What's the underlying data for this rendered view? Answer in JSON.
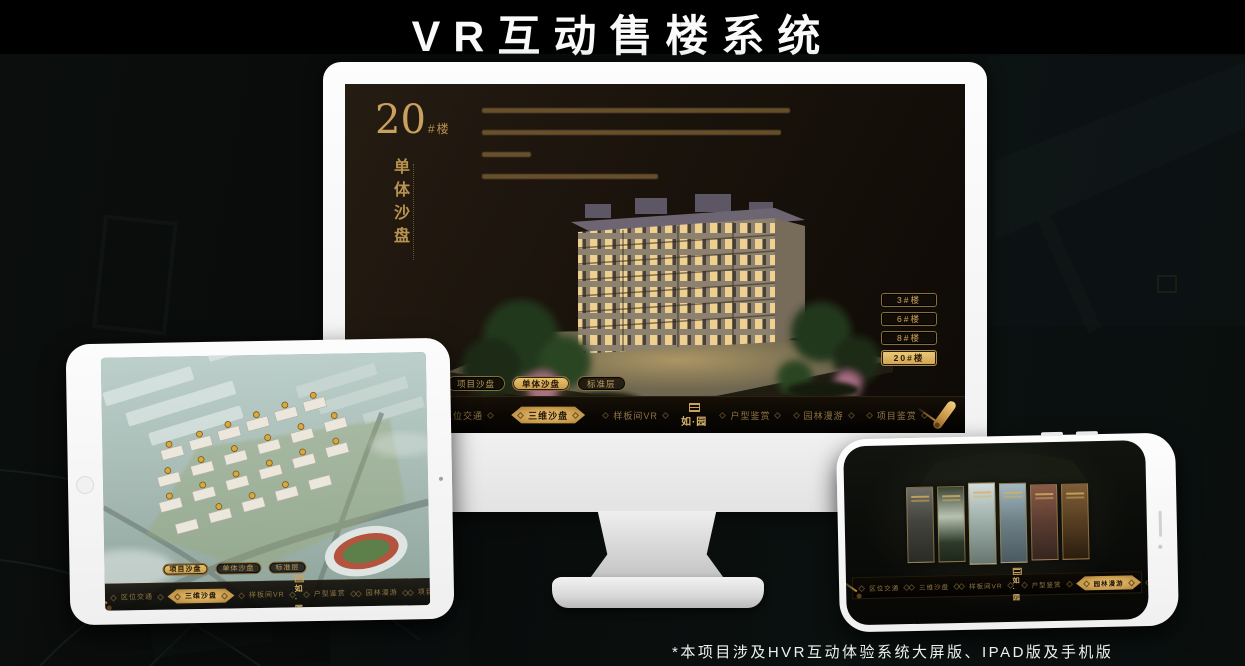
{
  "page": {
    "title": "VR互动售楼系统",
    "footnote": "*本项目涉及HVR互动体验系统大屏版、IPAD版及手机版"
  },
  "brand": {
    "logo": "如·园"
  },
  "colors": {
    "gold": "#c9a05e",
    "gold_selected": "#e8c06a",
    "screen_bg": "#1a130c",
    "nav_text": "#8f7443",
    "title_text": "#fafafa"
  },
  "monitor": {
    "heading": {
      "number": "20",
      "suffix": "#楼",
      "subtitle": "单体沙盘"
    },
    "floor_buttons": [
      {
        "label": "3#楼",
        "selected": false
      },
      {
        "label": "6#楼",
        "selected": false
      },
      {
        "label": "8#楼",
        "selected": false
      },
      {
        "label": "20#楼",
        "selected": true
      }
    ],
    "sub_tabs": [
      {
        "label": "项目沙盘",
        "selected": false
      },
      {
        "label": "单体沙盘",
        "selected": true
      },
      {
        "label": "标准层",
        "selected": false
      }
    ],
    "nav_items": [
      {
        "label": "区位交通",
        "selected": false
      },
      {
        "label": "三维沙盘",
        "selected": true
      },
      {
        "label": "样板间VR",
        "selected": false
      },
      {
        "label": "户型鉴赏",
        "selected": false
      },
      {
        "label": "园林漫游",
        "selected": false
      },
      {
        "label": "项目鉴赏",
        "selected": false
      }
    ]
  },
  "tablet": {
    "sub_tabs": [
      {
        "label": "项目沙盘",
        "selected": true
      },
      {
        "label": "单体沙盘",
        "selected": false
      },
      {
        "label": "标准层",
        "selected": false
      }
    ],
    "nav_items": [
      {
        "label": "区位交通",
        "selected": false
      },
      {
        "label": "三维沙盘",
        "selected": true
      },
      {
        "label": "样板间VR",
        "selected": false
      },
      {
        "label": "户型鉴赏",
        "selected": false
      },
      {
        "label": "园林漫游",
        "selected": false
      },
      {
        "label": "项目鉴赏",
        "selected": false
      }
    ]
  },
  "phone": {
    "nav_items": [
      {
        "label": "区位交通",
        "selected": false
      },
      {
        "label": "三维沙盘",
        "selected": false
      },
      {
        "label": "样板间VR",
        "selected": false
      },
      {
        "label": "户型鉴赏",
        "selected": false
      },
      {
        "label": "园林漫游",
        "selected": true
      },
      {
        "label": "项目鉴赏",
        "selected": false
      }
    ]
  }
}
